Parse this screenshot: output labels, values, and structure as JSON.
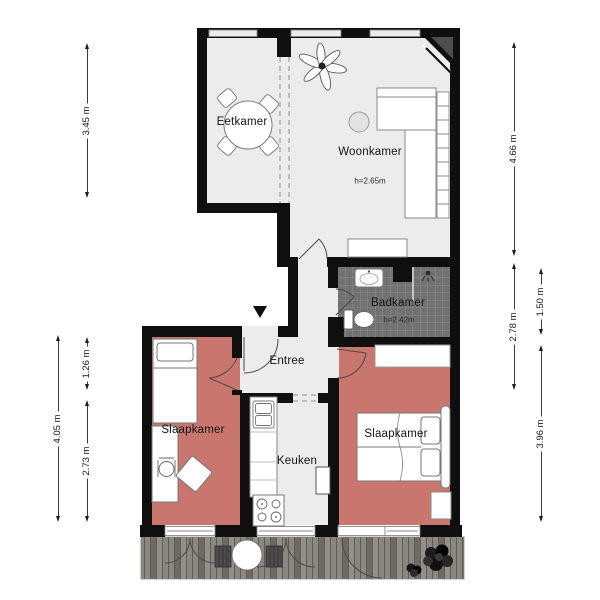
{
  "plan": {
    "type": "floorplan",
    "language": "nl"
  },
  "rooms": [
    {
      "id": "eetkamer",
      "label": "Eetkamer"
    },
    {
      "id": "woonkamer",
      "label": "Woonkamer",
      "height": "h=2.65m"
    },
    {
      "id": "badkamer",
      "label": "Badkamer",
      "height": "h=2.42m"
    },
    {
      "id": "entree",
      "label": "Entree"
    },
    {
      "id": "slaapkamer-links",
      "label": "Slaapkamer"
    },
    {
      "id": "keuken",
      "label": "Keuken"
    },
    {
      "id": "slaapkamer-rechts",
      "label": "Slaapkamer"
    }
  ],
  "dimensions": {
    "left": [
      {
        "label": "3.45 m"
      },
      {
        "label": "4.05 m"
      },
      {
        "label": "1.26 m"
      },
      {
        "label": "2.73 m"
      }
    ],
    "right": [
      {
        "label": "4.66 m"
      },
      {
        "label": "2.78 m"
      },
      {
        "label": "1.50 m"
      },
      {
        "label": "3.96 m"
      }
    ]
  },
  "colors": {
    "floor": "#ececec",
    "bedroom": "#c9776e",
    "wall": "#0f0f0f",
    "tile-base": "#717171",
    "tile-line": "#949494",
    "deck-light": "#948f87",
    "deck-mid": "#8a8680",
    "deck-dark": "#6e6a62",
    "deck-line": "#5f5b55",
    "window-fill": "#ededed",
    "outline": "#7d7d7d"
  }
}
